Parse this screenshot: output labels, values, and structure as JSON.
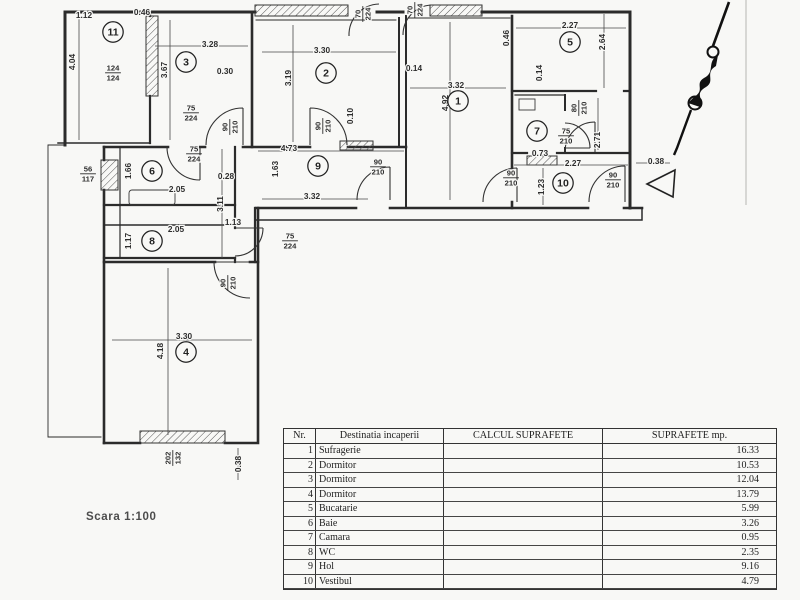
{
  "scan": {
    "scale_label": "Scara 1:100"
  },
  "plan": {
    "rooms": [
      {
        "num": "1",
        "x": 458,
        "y": 101
      },
      {
        "num": "2",
        "x": 326,
        "y": 73
      },
      {
        "num": "3",
        "x": 186,
        "y": 62
      },
      {
        "num": "4",
        "x": 186,
        "y": 352
      },
      {
        "num": "5",
        "x": 570,
        "y": 42
      },
      {
        "num": "6",
        "x": 152,
        "y": 171
      },
      {
        "num": "7",
        "x": 537,
        "y": 131
      },
      {
        "num": "8",
        "x": 152,
        "y": 241
      },
      {
        "num": "9",
        "x": 318,
        "y": 166
      },
      {
        "num": "10",
        "x": 563,
        "y": 183
      },
      {
        "num": "11",
        "x": 113,
        "y": 32
      }
    ],
    "dims": [
      {
        "t": "1.12",
        "x": 84,
        "y": 15,
        "r": 0
      },
      {
        "t": "0.46",
        "x": 142,
        "y": 12,
        "r": 0
      },
      {
        "t": "4.04",
        "x": 72,
        "y": 62,
        "r": -90
      },
      {
        "t": "3.28",
        "x": 210,
        "y": 44,
        "r": 0
      },
      {
        "t": "0.30",
        "x": 225,
        "y": 71,
        "r": 0
      },
      {
        "t": "3.67",
        "x": 164,
        "y": 70,
        "r": -90
      },
      {
        "t": "3.30",
        "x": 322,
        "y": 50,
        "r": 0
      },
      {
        "t": "3.19",
        "x": 288,
        "y": 78,
        "r": -90
      },
      {
        "t": "0.14",
        "x": 414,
        "y": 68,
        "r": 0
      },
      {
        "t": "0.10",
        "x": 350,
        "y": 116,
        "r": -90
      },
      {
        "t": "3.32",
        "x": 456,
        "y": 85,
        "r": 0
      },
      {
        "t": "4.92",
        "x": 445,
        "y": 103,
        "r": -90
      },
      {
        "t": "0.46",
        "x": 506,
        "y": 38,
        "r": -90
      },
      {
        "t": "2.27",
        "x": 570,
        "y": 25,
        "r": 0
      },
      {
        "t": "2.64",
        "x": 602,
        "y": 42,
        "r": -90
      },
      {
        "t": "0.14",
        "x": 539,
        "y": 73,
        "r": -90
      },
      {
        "t": "0.73",
        "x": 540,
        "y": 153,
        "r": 0
      },
      {
        "t": "2.71",
        "x": 597,
        "y": 140,
        "r": -90
      },
      {
        "t": "2.27",
        "x": 573,
        "y": 163,
        "r": 0
      },
      {
        "t": "1.23",
        "x": 541,
        "y": 187,
        "r": -90
      },
      {
        "t": "0.38",
        "x": 656,
        "y": 161,
        "r": 0
      },
      {
        "t": "4.73",
        "x": 289,
        "y": 148,
        "r": 0
      },
      {
        "t": "1.63",
        "x": 275,
        "y": 169,
        "r": -90
      },
      {
        "t": "0.28",
        "x": 226,
        "y": 176,
        "r": 0
      },
      {
        "t": "3.32",
        "x": 312,
        "y": 196,
        "r": 0
      },
      {
        "t": "3.11",
        "x": 220,
        "y": 204,
        "r": -90
      },
      {
        "t": "1.13",
        "x": 233,
        "y": 222,
        "r": 0
      },
      {
        "t": "2.05",
        "x": 177,
        "y": 189,
        "r": 0
      },
      {
        "t": "1.66",
        "x": 128,
        "y": 171,
        "r": -90
      },
      {
        "t": "2.05",
        "x": 176,
        "y": 229,
        "r": 0
      },
      {
        "t": "1.17",
        "x": 128,
        "y": 241,
        "r": -90
      },
      {
        "t": "3.30",
        "x": 184,
        "y": 336,
        "r": 0
      },
      {
        "t": "4.18",
        "x": 160,
        "y": 351,
        "r": -90
      },
      {
        "t": "0.38",
        "x": 238,
        "y": 464,
        "r": -90
      }
    ],
    "door_window_labels": [
      {
        "top": "124",
        "bot": "124",
        "x": 113,
        "y": 72,
        "r": 0
      },
      {
        "top": "56",
        "bot": "117",
        "x": 88,
        "y": 173,
        "r": 0
      },
      {
        "top": "202",
        "bot": "132",
        "x": 172,
        "y": 458,
        "r": -90
      },
      {
        "top": "75",
        "bot": "224",
        "x": 191,
        "y": 112,
        "r": 0
      },
      {
        "top": "90",
        "bot": "210",
        "x": 229,
        "y": 127,
        "r": -90
      },
      {
        "top": "90",
        "bot": "210",
        "x": 322,
        "y": 126,
        "r": -90
      },
      {
        "top": "70",
        "bot": "224",
        "x": 362,
        "y": 14,
        "r": -90
      },
      {
        "top": "70",
        "bot": "224",
        "x": 414,
        "y": 10,
        "r": -90
      },
      {
        "top": "90",
        "bot": "210",
        "x": 378,
        "y": 166,
        "r": 0
      },
      {
        "top": "90",
        "bot": "210",
        "x": 511,
        "y": 177,
        "r": 0
      },
      {
        "top": "90",
        "bot": "210",
        "x": 613,
        "y": 179,
        "r": 0
      },
      {
        "top": "90",
        "bot": "210",
        "x": 227,
        "y": 283,
        "r": -90
      },
      {
        "top": "75",
        "bot": "224",
        "x": 194,
        "y": 153,
        "r": 0
      },
      {
        "top": "75",
        "bot": "224",
        "x": 290,
        "y": 240,
        "r": 0
      },
      {
        "top": "80",
        "bot": "210",
        "x": 578,
        "y": 108,
        "r": -90
      },
      {
        "top": "75",
        "bot": "210",
        "x": 566,
        "y": 135,
        "r": 0
      }
    ]
  },
  "table": {
    "headers": [
      "Nr.",
      "Destinatia incaperii",
      "CALCUL SUPRAFETE",
      "SUPRAFETE mp."
    ],
    "rows": [
      {
        "nr": "1",
        "name": "Sufragerie",
        "calc": "",
        "mp": "16.33"
      },
      {
        "nr": "2",
        "name": "Dormitor",
        "calc": "",
        "mp": "10.53"
      },
      {
        "nr": "3",
        "name": "Dormitor",
        "calc": "",
        "mp": "12.04"
      },
      {
        "nr": "4",
        "name": "Dormitor",
        "calc": "",
        "mp": "13.79"
      },
      {
        "nr": "5",
        "name": "Bucatarie",
        "calc": "",
        "mp": "5.99"
      },
      {
        "nr": "6",
        "name": "Baie",
        "calc": "",
        "mp": "3.26"
      },
      {
        "nr": "7",
        "name": "Camara",
        "calc": "",
        "mp": "0.95"
      },
      {
        "nr": "8",
        "name": "WC",
        "calc": "",
        "mp": "2.35"
      },
      {
        "nr": "9",
        "name": "Hol",
        "calc": "",
        "mp": "9.16"
      },
      {
        "nr": "10",
        "name": "Vestibul",
        "calc": "",
        "mp": "4.79"
      }
    ]
  }
}
